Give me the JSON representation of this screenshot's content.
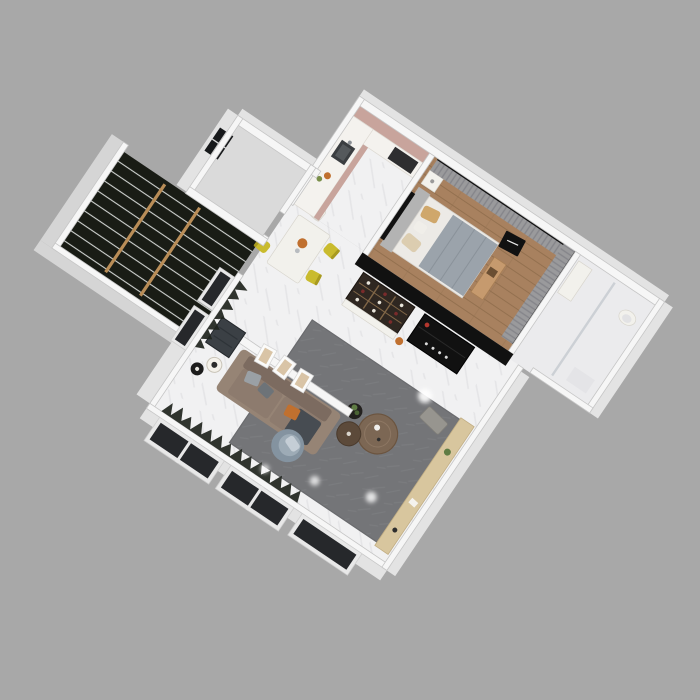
{
  "scene": {
    "description": "3D axonometric render of a one-bedroom apartment floor plan on a plain gray backdrop",
    "view": "top-down rotated 34 degrees",
    "background": "#a8a8a8"
  },
  "palette": {
    "bg": "#a8a8a8",
    "wallTop": "#f6f6f6",
    "wallEdge": "#c6c6c6",
    "wallFace": "#e3e3e3",
    "wallFaceDark": "#d5d5d5",
    "marble": "#f1f1f2",
    "marbleStreak": "#e0e0e3",
    "wood": "#a8815f",
    "woodLine": "#93704f",
    "curtain": "#9a9a9c",
    "curtainDark": "#85858a",
    "blackPanel": "#111111",
    "stairBase": "#191c15",
    "stairEdge": "#cfd2cf",
    "rail": "#b98d57",
    "rug": "#747578",
    "rugLine": "#7e7f82",
    "sofaBase": "#8d7b6e",
    "sofaDark": "#7c6b60",
    "sofaArm": "#968475",
    "pillowGray": "#9aa0a5",
    "orange": "#c0702f",
    "throw": "#474c52",
    "armBase": "#8493a0",
    "armSeat": "#9dabb6",
    "armPillow": "#c5ced6",
    "woodTable": "#7c6754",
    "woodTableDark": "#5c4a3a",
    "yellow": "#c9bb2e",
    "chairWhite": "#f2f1ec",
    "pinkCab": "#c8a49c",
    "counter": "#f4f2ee",
    "sinkDark": "#3b3e41",
    "applianceDark": "#2e2e30",
    "bedBlanket": "#9ba3ab",
    "bedSheet": "#eceae6",
    "headboard": "#b3b3b3",
    "pillowTan": "#cfa76b",
    "pillowCream": "#dccdb0",
    "benchTan": "#c69a6e",
    "bathFloor": "#ebebed",
    "glassDark": "#26282b",
    "winFrame": "#e8e8e8",
    "plantDark": "#20241d",
    "plantGreen": "#5f7c44",
    "benchWood": "#d8c69e",
    "doorDark": "#3b4045",
    "wineCab": "#2f2721",
    "wineWood": "#806647",
    "nwFloor": "#dadada",
    "flare": "#ffffff"
  },
  "rooms": [
    {
      "name": "kitchen",
      "features": [
        "pink cabinets",
        "white counter",
        "dark sink",
        "hob"
      ]
    },
    {
      "name": "bedroom",
      "features": [
        "gray curtain walls",
        "double bed",
        "tan pillows",
        "wall tv",
        "black wardrobe wall",
        "wood plank floor"
      ]
    },
    {
      "name": "bathroom",
      "features": [
        "marble floor",
        "glass shower partition",
        "vanity",
        "toilet"
      ]
    },
    {
      "name": "storage-room",
      "features": [
        "black framed window",
        "empty gray floor"
      ]
    },
    {
      "name": "stairwell",
      "features": [
        "dark stone steps",
        "wooden handrails"
      ]
    },
    {
      "name": "dining-area",
      "features": [
        "white table",
        "yellow chairs",
        "orange flowers"
      ]
    },
    {
      "name": "living-room",
      "features": [
        "taupe sofa",
        "three picture frames",
        "gray rug",
        "round coffee tables",
        "blue-gray armchair",
        "floor lamp",
        "floor-to-ceiling dark windows",
        "window plants"
      ]
    },
    {
      "name": "corridor",
      "features": [
        "wine display cabinet",
        "black media unit"
      ]
    },
    {
      "name": "southeast-walkway",
      "features": [
        "marble floor",
        "light wood bench",
        "ceiling light flares"
      ]
    }
  ]
}
